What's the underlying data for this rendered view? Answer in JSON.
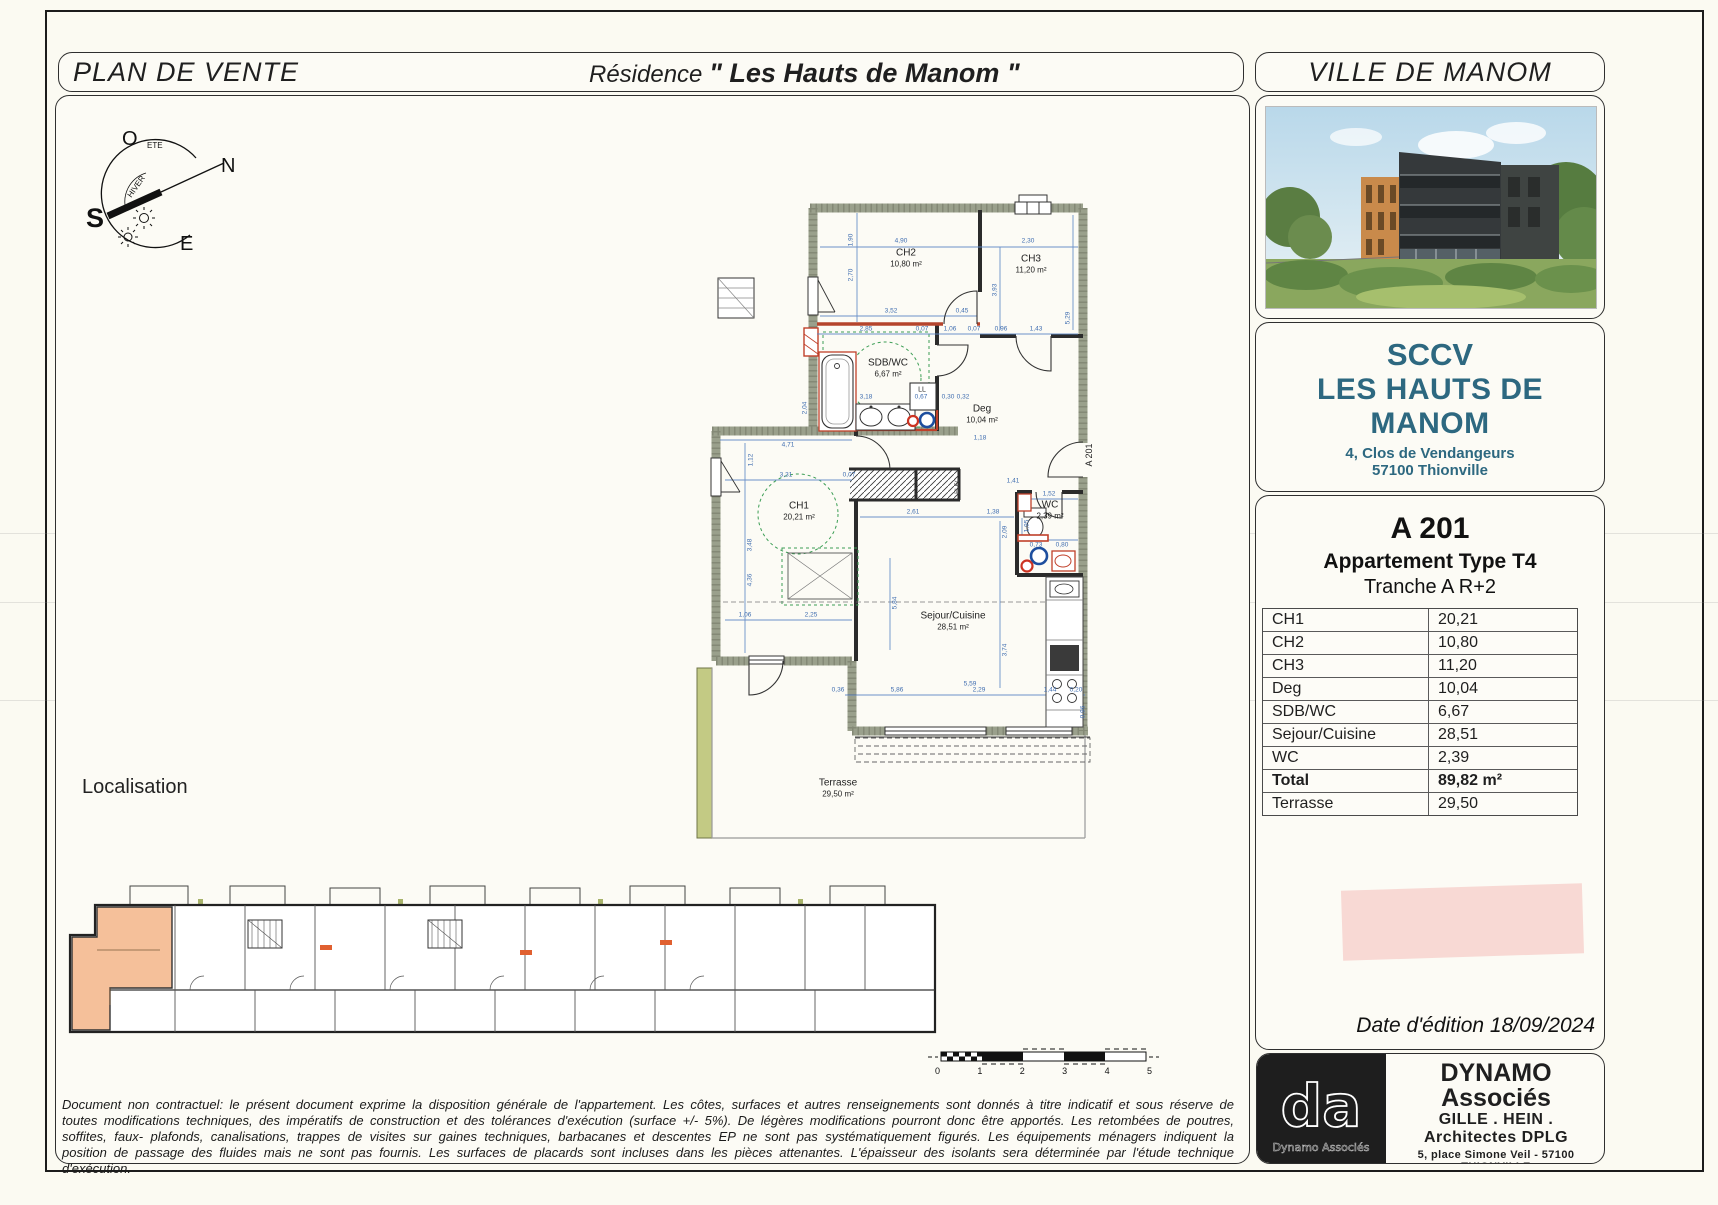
{
  "header": {
    "left_title": "PLAN DE VENTE",
    "residence_prefix": "Résidence",
    "residence_name": "\" Les Hauts de Manom \"",
    "right_title": "VILLE DE MANOM"
  },
  "compass": {
    "west": "O",
    "north": "N",
    "south": "S",
    "east": "E",
    "summer": "ETE",
    "winter": "HIVER"
  },
  "floor_plan": {
    "rooms": [
      {
        "name": "CH2",
        "area": "10,80 m²",
        "x": 906,
        "y": 258
      },
      {
        "name": "CH3",
        "area": "11,20 m²",
        "x": 1031,
        "y": 264
      },
      {
        "name": "SDB/WC",
        "area": "6,67 m²",
        "x": 888,
        "y": 368
      },
      {
        "name": "Deg",
        "area": "10,04 m²",
        "x": 982,
        "y": 414
      },
      {
        "name": "CH1",
        "area": "20,21 m²",
        "x": 799,
        "y": 511
      },
      {
        "name": "WC",
        "area": "2,39 m²",
        "x": 1050,
        "y": 510
      },
      {
        "name": "Sejour/Cuisine",
        "area": "28,51 m²",
        "x": 953,
        "y": 621
      },
      {
        "name": "Terrasse",
        "area": "29,50 m²",
        "x": 838,
        "y": 788
      }
    ],
    "tags": [
      {
        "t": "LL",
        "x": 922,
        "y": 390
      },
      {
        "t": "ELEC",
        "x": 958,
        "y": 486,
        "rot": -90
      },
      {
        "t": "A 201",
        "x": 1089,
        "y": 455,
        "rot": -90
      }
    ],
    "dimensions": [
      {
        "t": "4,90",
        "x": 901,
        "y": 241
      },
      {
        "t": "1,90",
        "x": 851,
        "y": 240,
        "rot": -90
      },
      {
        "t": "2,70",
        "x": 851,
        "y": 275,
        "rot": -90
      },
      {
        "t": "3,52",
        "x": 891,
        "y": 311
      },
      {
        "t": "0,45",
        "x": 962,
        "y": 311
      },
      {
        "t": "2,30",
        "x": 1028,
        "y": 241
      },
      {
        "t": "3,93",
        "x": 995,
        "y": 290,
        "rot": -90
      },
      {
        "t": "5,29",
        "x": 1068,
        "y": 318,
        "rot": -90
      },
      {
        "t": "2,85",
        "x": 866,
        "y": 329
      },
      {
        "t": "0,07",
        "x": 922,
        "y": 329
      },
      {
        "t": "1,06",
        "x": 950,
        "y": 329
      },
      {
        "t": "0,07",
        "x": 974,
        "y": 329
      },
      {
        "t": "0,96",
        "x": 1001,
        "y": 329
      },
      {
        "t": "1,43",
        "x": 1036,
        "y": 329
      },
      {
        "t": "2,04",
        "x": 805,
        "y": 408,
        "rot": -90
      },
      {
        "t": "3,18",
        "x": 866,
        "y": 397
      },
      {
        "t": "0,67",
        "x": 921,
        "y": 397
      },
      {
        "t": "0,30",
        "x": 948,
        "y": 397
      },
      {
        "t": "0,32",
        "x": 963,
        "y": 397
      },
      {
        "t": "4,71",
        "x": 788,
        "y": 445
      },
      {
        "t": "1,12",
        "x": 751,
        "y": 460,
        "rot": -90
      },
      {
        "t": "3,31",
        "x": 786,
        "y": 475
      },
      {
        "t": "0,07",
        "x": 849,
        "y": 475
      },
      {
        "t": "1,18",
        "x": 980,
        "y": 438
      },
      {
        "t": "1,41",
        "x": 1013,
        "y": 481
      },
      {
        "t": "1,52",
        "x": 1049,
        "y": 494
      },
      {
        "t": "1,95",
        "x": 1027,
        "y": 526,
        "rot": -90
      },
      {
        "t": "0,73",
        "x": 1036,
        "y": 545
      },
      {
        "t": "0,80",
        "x": 1062,
        "y": 545
      },
      {
        "t": "3,48",
        "x": 750,
        "y": 545,
        "rot": -90
      },
      {
        "t": "4,36",
        "x": 750,
        "y": 580,
        "rot": -90
      },
      {
        "t": "2,61",
        "x": 913,
        "y": 512
      },
      {
        "t": "1,38",
        "x": 993,
        "y": 512
      },
      {
        "t": "2,09",
        "x": 1005,
        "y": 532,
        "rot": -90
      },
      {
        "t": "5,84",
        "x": 895,
        "y": 603,
        "rot": -90
      },
      {
        "t": "1,06",
        "x": 745,
        "y": 615
      },
      {
        "t": "2,25",
        "x": 811,
        "y": 615
      },
      {
        "t": "3,74",
        "x": 1005,
        "y": 650,
        "rot": -90
      },
      {
        "t": "0,36",
        "x": 838,
        "y": 690
      },
      {
        "t": "5,86",
        "x": 897,
        "y": 690
      },
      {
        "t": "5,59",
        "x": 970,
        "y": 684
      },
      {
        "t": "2,29",
        "x": 979,
        "y": 690
      },
      {
        "t": "1,44",
        "x": 1050,
        "y": 690
      },
      {
        "t": "0,20",
        "x": 1076,
        "y": 690
      },
      {
        "t": "0,96",
        "x": 1083,
        "y": 712,
        "rot": -90
      }
    ]
  },
  "localisation_label": "Localisation",
  "scale_bar": {
    "ticks": [
      "0",
      "1",
      "2",
      "3",
      "4",
      "5"
    ]
  },
  "sidebar": {
    "city": "VILLE DE MANOM",
    "company": {
      "name_line1": "SCCV",
      "name_line2": "LES HAUTS DE MANOM",
      "address_line1": "4, Clos de Vendangeurs",
      "address_line2": "57100 Thionville"
    },
    "unit": {
      "code": "A 201",
      "type": "Appartement Type T4",
      "tranche": "Tranche A R+2"
    },
    "areas": [
      {
        "label": "CH1",
        "value": "20,21"
      },
      {
        "label": "CH2",
        "value": "10,80"
      },
      {
        "label": "CH3",
        "value": "11,20"
      },
      {
        "label": "Deg",
        "value": "10,04"
      },
      {
        "label": "SDB/WC",
        "value": "6,67"
      },
      {
        "label": "Sejour/Cuisine",
        "value": "28,51"
      },
      {
        "label": "WC",
        "value": "2,39"
      },
      {
        "label": "Total",
        "value": "89,82 m²",
        "bold": true
      },
      {
        "label": "Terrasse",
        "value": "29,50"
      }
    ],
    "edition_date": "Date d'édition 18/09/2024"
  },
  "architect": {
    "logo": "da",
    "logo_caption": "Dynamo Associés",
    "name": "DYNAMO Associés",
    "title": "GILLE . HEIN . Architectes DPLG",
    "address": "5, place Simone Veil - 57100 THIONVILLE",
    "phone": "Tél: +33 (0)3 82 82 12 72 - Fax: +33 (0)3 82 82 12 73",
    "email": "contact@dynamo-associes.fr"
  },
  "disclaimer": "Document non contractuel: le présent document exprime la disposition générale de l'appartement. Les côtes, surfaces et autres renseignements sont donnés à titre indicatif et sous réserve de toutes modifications techniques, des impératifs de construction et des tolérances d'exécution (surface +/- 5%). De légères modifications pourront donc être apportés. Les retombées de poutres, soffites, faux- plafonds, canalisations, trappes de visites sur gaines techniques, barbacanes et descentes EP ne sont pas systématiquement figurés. Les équipements ménagers indiquent la position de passage des fluides mais ne sont pas fournis. Les surfaces de placards sont incluses dans les pièces attenantes. L'épaisseur des isolants sera déterminée par l'étude technique d'exécution."
}
